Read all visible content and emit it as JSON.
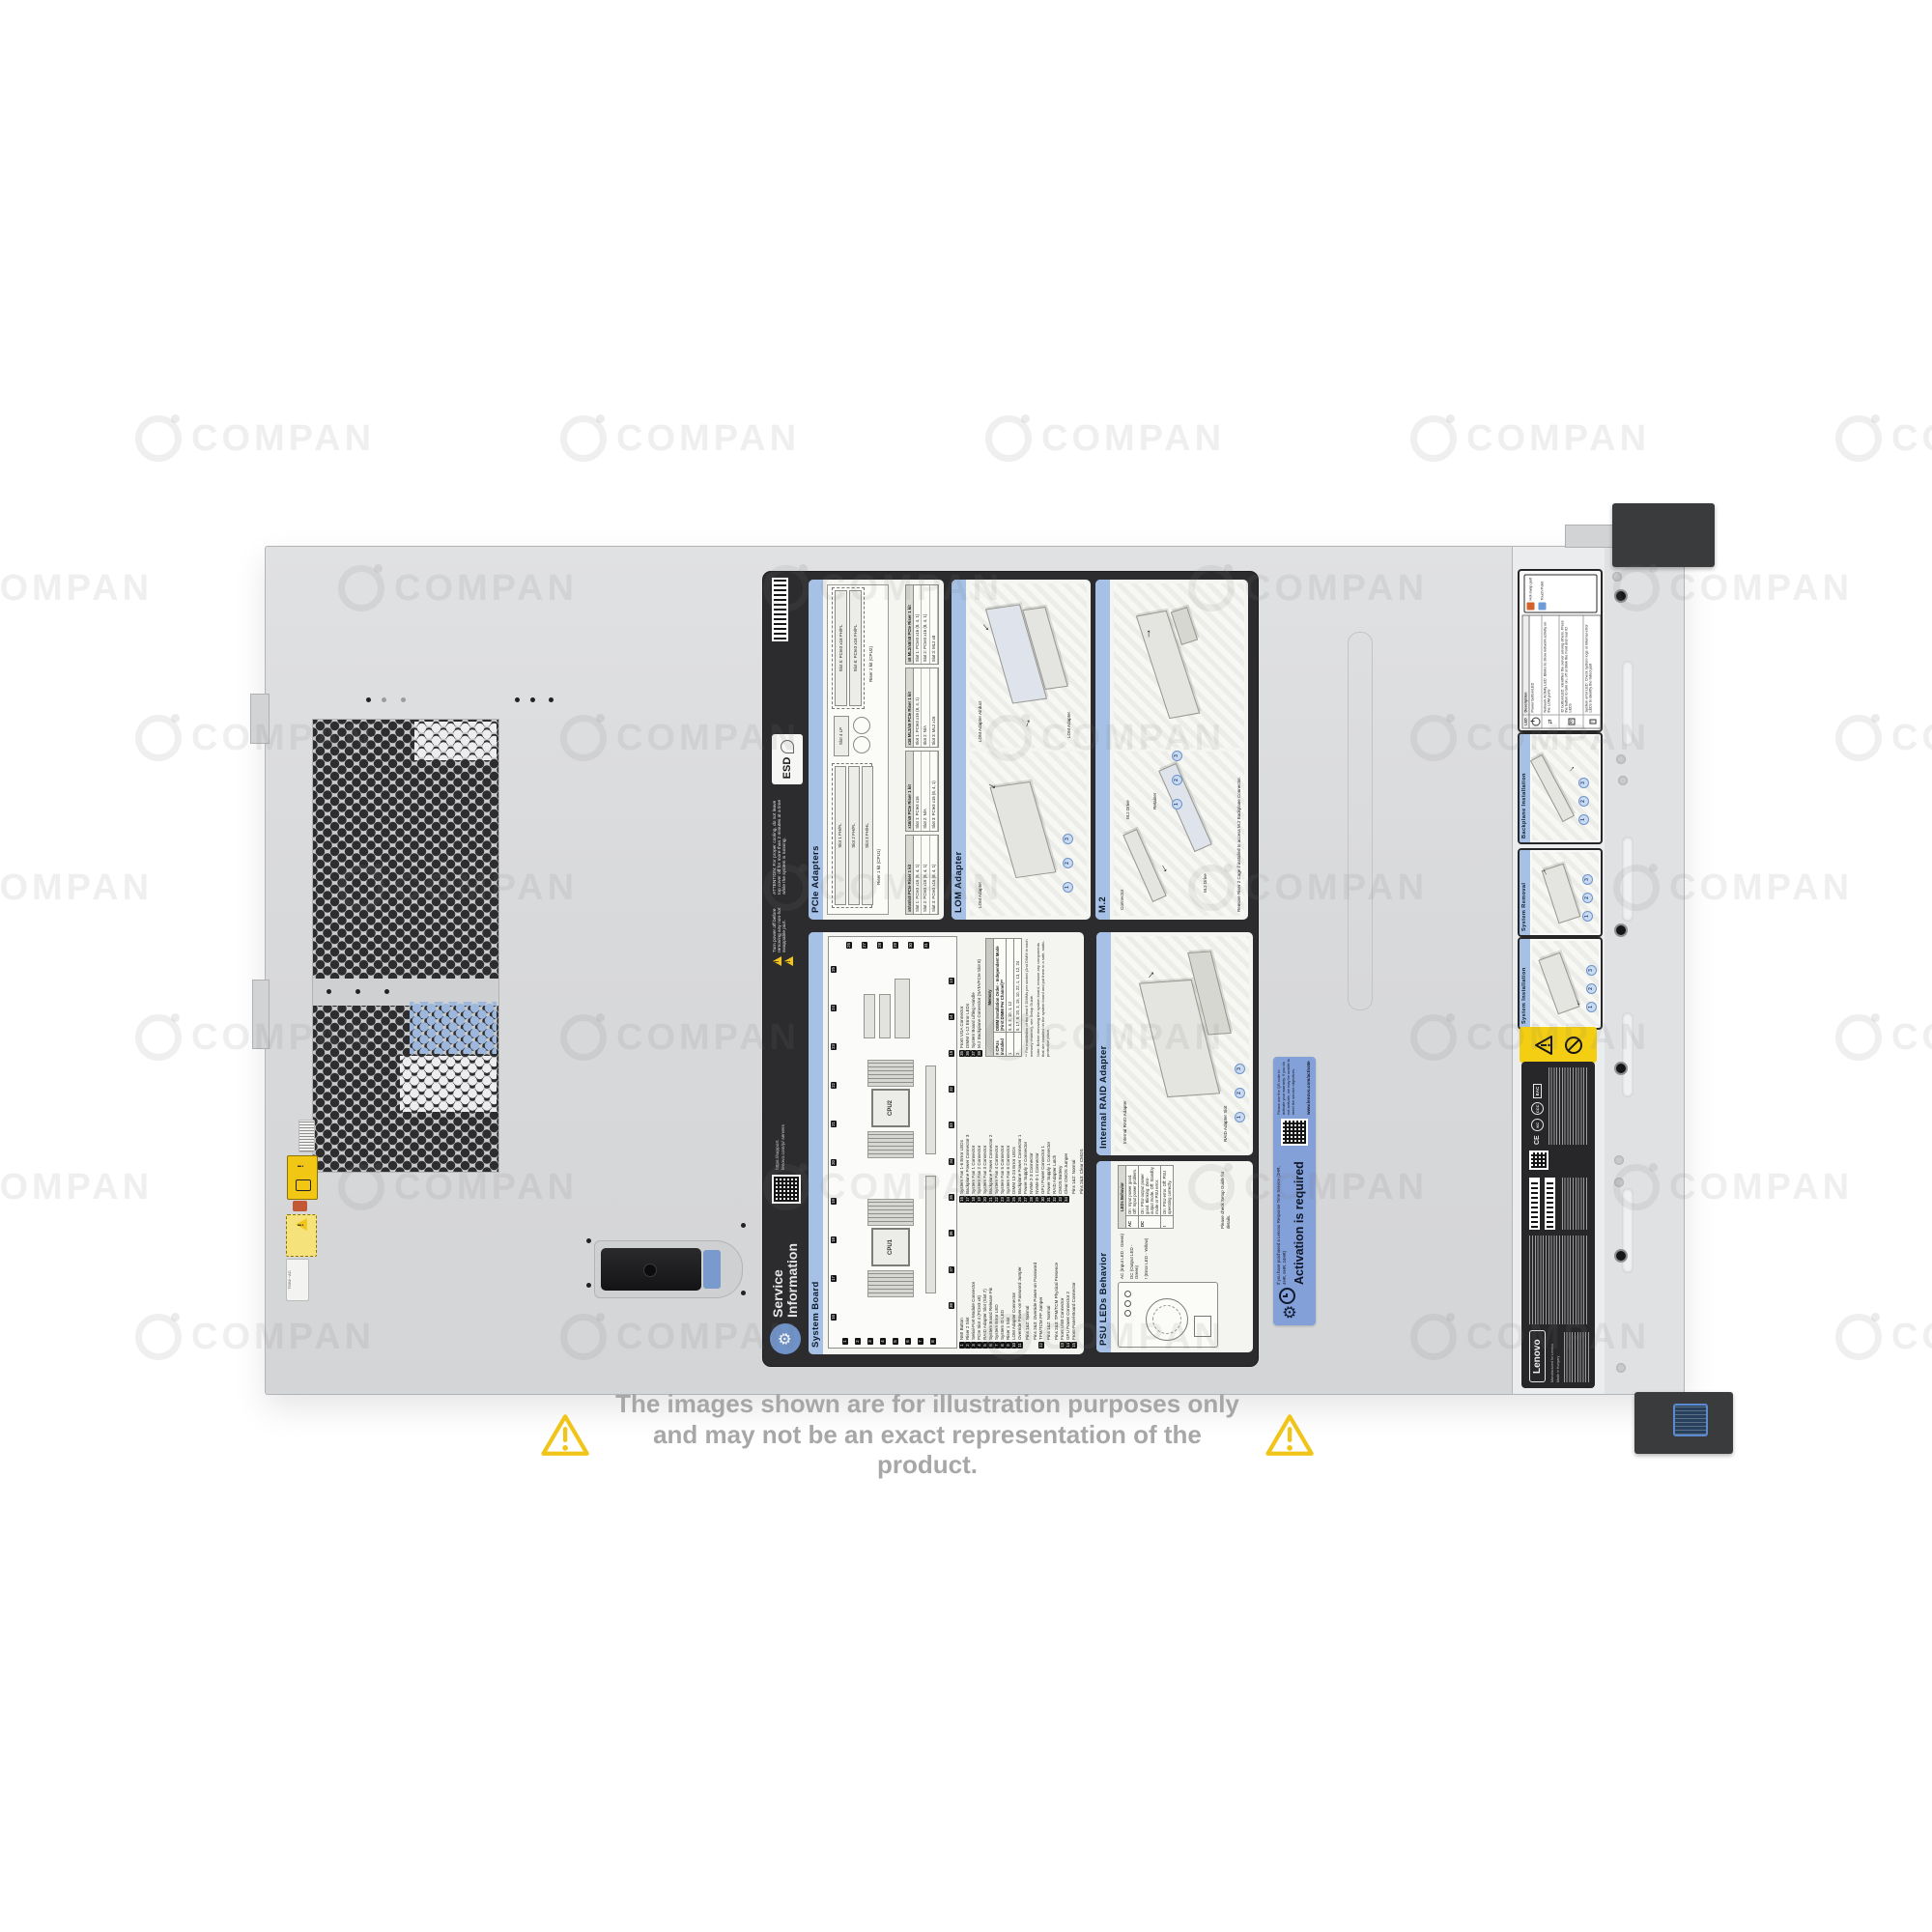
{
  "watermark": {
    "text": "COMPAN"
  },
  "disclaimer": {
    "line1": "The images shown are for illustration purposes only",
    "line2": "and may not be an exact representation of the product."
  },
  "colors": {
    "label_header_blue": "#a6c1e5",
    "activation_blue": "#83a0d8",
    "warning_yellow": "#f4ce12",
    "disclaimer_yellow": "#f0c419"
  },
  "psu_rating": "750W ~AC",
  "steps": [
    "1",
    "2",
    "3"
  ],
  "label": {
    "title_line1": "Service",
    "title_line2": "Information",
    "support_url": "https://support. lenovo.com/p/ servers",
    "power_warning": "Turn power off before removing any non-hot swappable part.",
    "attention": "ATTENTION: For proper cooling, do not leave top cover off for more than 2 minutes at a time while the system is running.",
    "esd": "ESD",
    "cards": {
      "pcie": {
        "title": "PCIe Adapters",
        "riser1_caption": "Riser 1 kit (CPU1)",
        "riser2_caption": "Riser 2 kit (CPU2)",
        "riser1_slots": [
          "Slot 1 FH/FL",
          "Slot 2 FH/FL",
          "Slot 3 FH/HL"
        ],
        "slot4": "Slot 4 LP",
        "riser2_slots": [
          "Slot 5: PCIe3 x16 FH/FL",
          "Slot 6: PCIe3 x16 FH/FL"
        ],
        "tables": [
          {
            "title": "x8/x8/x8 PCIe Riser 1 kit",
            "rows": [
              "Slot 1: PCIe3 x16 (8, 4, 1)",
              "Slot 2: PCIe3 x16 (8, 4, 1)",
              "Slot 3: PCIe3 x16 (8, 4, 1)"
            ]
          },
          {
            "title": "x16/x8 PCIe Riser 1 kit",
            "rows": [
              "Slot 1: PCIe3 x16",
              "Slot 2: N/A",
              "Slot 3: PCIe3 x16 (8, 4, 1)"
            ]
          },
          {
            "title": "x16 ML2/x8 PCIe Riser 1 kit",
            "rows": [
              "Slot 1: PCIe3 x16 (8, 4, 1)",
              "Slot 2: N/A",
              "Slot 3: ML2 x16"
            ]
          },
          {
            "title": "x8 ML2/x8/x8 PCIe Riser 1 kit",
            "rows": [
              "Slot 1: PCIe3 x16 (8, 4, 1)",
              "Slot 2: PCIe3 x16 (8, 4, 1)",
              "Slot 3: ML2 x8"
            ]
          }
        ]
      },
      "lom": {
        "title": "LOM Adapter",
        "label_left": "LOM Adapter",
        "label_right_1": "LOM Adapter Airduct",
        "label_right_2": "LOM Adapter"
      },
      "m2": {
        "title": "M.2",
        "labels": [
          "Connector",
          "M.2 Drive",
          "Retainer",
          "M.2 Drive"
        ],
        "note": "Remove Riser 2 Cage if installed to access M.2 Backplane Connector."
      },
      "system_board": {
        "title": "System Board",
        "cpu1": "CPU1",
        "cpu2": "CPU2",
        "callouts_top": [
          "16",
          "17",
          "18",
          "19",
          "20",
          "21",
          "22",
          "23",
          "24",
          "25"
        ],
        "callouts_left": [
          "1",
          "2",
          "3",
          "4",
          "5",
          "6",
          "7",
          "8"
        ],
        "callouts_right": [
          "26",
          "27",
          "28",
          "29",
          "30",
          "31"
        ],
        "callouts_bottom": [
          "38",
          "37",
          "36",
          "35",
          "34",
          "33",
          "32",
          "15",
          "14",
          "13"
        ],
        "legend_col1": [
          {
            "n": "1",
            "t": "NMI Button"
          },
          {
            "n": "2",
            "t": "Riser 2 Slot"
          },
          {
            "n": "3",
            "t": "Serial-Port-Module Connector"
          },
          {
            "n": "4",
            "t": "PCIe Slot 4 (PCIe3 x8)"
          },
          {
            "n": "5",
            "t": "RAID Adapter Slot (Slot 7)"
          },
          {
            "n": "6",
            "t": "System Board Release Pin"
          },
          {
            "n": "7",
            "t": "System Error LED"
          },
          {
            "n": "8",
            "t": "System ID LED"
          },
          {
            "n": "9",
            "t": "Riser 1 Slot"
          },
          {
            "n": "10",
            "t": "LOM Adapter Connector"
          },
          {
            "n": "11",
            "t": "Override Power-on Password Jumper"
          },
          {
            "n": "",
            "t": "Pins 1&2: Normal"
          },
          {
            "n": "",
            "t": "Pins 2&3: Override Power-on Password"
          },
          {
            "n": "12",
            "t": "TPM/TCM PP Jumper"
          },
          {
            "n": "",
            "t": "Pins 1&2: Normal"
          },
          {
            "n": "",
            "t": "Pins 2&3: TPM/TCM Physical Presence"
          },
          {
            "n": "13",
            "t": "Front USB Connector"
          },
          {
            "n": "14",
            "t": "GPU Power Connector 2"
          },
          {
            "n": "15",
            "t": "Front-Panel-Board Connector"
          }
        ],
        "legend_col2": [
          {
            "n": "16",
            "t": "System Fan 1-6 Error LEDs"
          },
          {
            "n": "17",
            "t": "Backplane Power Connector 3"
          },
          {
            "n": "18",
            "t": "System Fan 1 Connector"
          },
          {
            "n": "19",
            "t": "System Fan 2 Connector"
          },
          {
            "n": "20",
            "t": "System Fan 3 Connector"
          },
          {
            "n": "21",
            "t": "Backplane Power Connector 2"
          },
          {
            "n": "22",
            "t": "System Fan 4 Connector"
          },
          {
            "n": "23",
            "t": "System Fan 5 Connector"
          },
          {
            "n": "24",
            "t": "System Fan 6 Connector"
          },
          {
            "n": "25",
            "t": "DIMM 13-24 Error LEDs"
          },
          {
            "n": "26",
            "t": "Backplane Power Connector 1"
          },
          {
            "n": "27",
            "t": "Power Supply 2 Connector"
          },
          {
            "n": "28",
            "t": "NVMe 2-3 Connector"
          },
          {
            "n": "29",
            "t": "NVMe 0-1 Connector"
          },
          {
            "n": "30",
            "t": "GPU Power Connector 1"
          },
          {
            "n": "31",
            "t": "Power Supply 1 Connector"
          },
          {
            "n": "32",
            "t": "RAID Adapter Latch"
          },
          {
            "n": "33",
            "t": "CMOS Battery"
          },
          {
            "n": "34",
            "t": "Clear CMOS Jumper"
          },
          {
            "n": "",
            "t": "Pins 1&2: Normal"
          },
          {
            "n": "",
            "t": "Pins 2&3: Clear CMOS"
          }
        ],
        "legend_col3": [
          {
            "n": "35",
            "t": "Front VGA Connector"
          },
          {
            "n": "36",
            "t": "DIMM 1-12 Error LEDs"
          },
          {
            "n": "37",
            "t": "System Board Lifting Handle"
          },
          {
            "n": "38",
            "t": "M.2 Backplane Connector (SATA/PCIe Slot 8)"
          }
        ],
        "note": "Note: Before removing the system board, remove any components that are installed on the system board and put them in a safe, static-protective place.",
        "memory": {
          "title": "Memory",
          "col1_header": "# CPUs Installed",
          "col2_header": "DIMM Installation Order - Independent Mode (First DIMM Per Channel)**",
          "rows": [
            {
              "cpus": "1",
              "order": "5, 8, 3, 10, 1, 12"
            },
            {
              "cpus": "2",
              "order": "5, 17, 8, 20, 3, 15, 10, 22, 1, 13, 12, 24"
            }
          ],
          "footnote": "** For installation of the next 6 DIMMs per socket (2nd DIMM in each memory channel), see Setup Guide."
        }
      },
      "raid": {
        "title": "Internal RAID Adapter",
        "label_adapter": "Internal RAID Adapter",
        "label_slot": "RAID Adapter Slot"
      },
      "psu": {
        "title": "PSU LEDs Behavior",
        "led_labels": [
          "AC (Input LED - Green)",
          "DC (Output LED - Green)",
          "!  (Error LED - Yellow)"
        ],
        "table_title": "LEDs Behavior",
        "rows": [
          {
            "led": "AC",
            "desc": "On: Input power good.  Off: Input power problem."
          },
          {
            "led": "DC",
            "desc": "On: PSU output power good.  Blinking: Zero-output mode.  Off: Standby mode or PSU error."
          },
          {
            "led": "!",
            "desc": "On: PSU error.  Off: PSU operating correctly."
          }
        ],
        "note": "Please check Setup Guide for details."
      }
    }
  },
  "activation": {
    "headline": "Activation is required",
    "subtext": "If you have purchased a Lenovo Response Time Service (2HR, 4HR, 6HR, 24HR)",
    "qr_caption": "Please use the QR code to activate your warranty. If you do not activate, we may be unable to meet the service objectives.",
    "url": "www.lenovo.com/activate"
  },
  "front_panel": {
    "key": {
      "hot_swap": "Hot-swap part",
      "touch_point": "Touch Point"
    },
    "led_table": {
      "header_led": "LED",
      "header_desc": "Description",
      "rows": [
        {
          "desc": "Power button/LED"
        },
        {
          "desc": "Network Activity LED: Blinks to show network activity on the LOM ports"
        },
        {
          "desc": "ID button/LED: Identifies the server among others. Press the button to turn on, off or blink the front and rear ID LEDs"
        },
        {
          "desc": "System error LED: Check system logs or internal error LEDs to identify the failed part"
        }
      ]
    },
    "cards": {
      "backplane": "Backplane Installation",
      "removal": "System Removal",
      "install": "System Installation"
    }
  },
  "regulatory": {
    "brand": "Lenovo",
    "made_line1": "Manufactured for Lenovo",
    "made_line2": "Made in Hungary"
  }
}
